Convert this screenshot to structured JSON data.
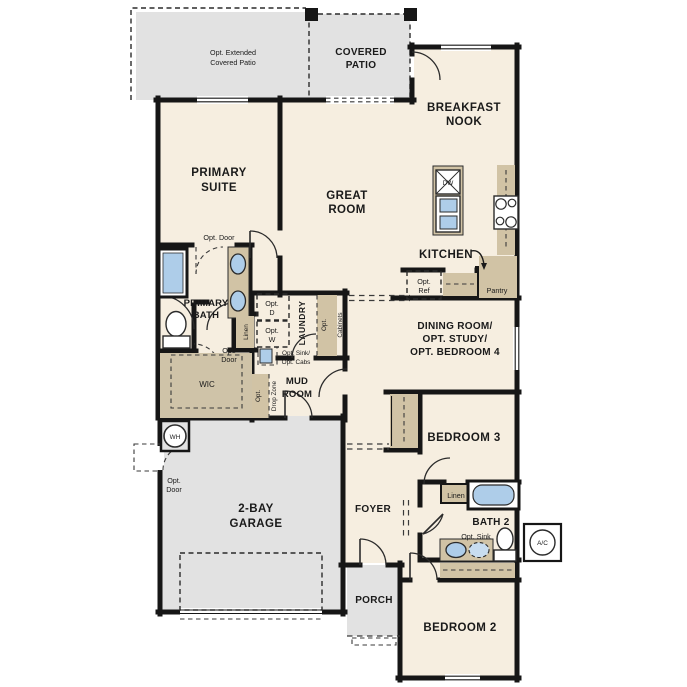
{
  "plan": {
    "title": "Single-story floor plan",
    "colors": {
      "floor": "#f6eee0",
      "outdoor_concrete": "#e2e2e2",
      "cabinet_tan": "#d1c3a5",
      "fixture_blue": "#aecde9",
      "wall": "#161616",
      "opt_box_gray": "#e8e8e4"
    },
    "outdoor": {
      "opt_extended_patio": {
        "lines": [
          "Opt. Extended",
          "Covered Patio"
        ]
      },
      "covered_patio": {
        "lines": [
          "COVERED",
          "PATIO"
        ]
      },
      "porch": {
        "label": "PORCH"
      },
      "garage": {
        "lines": [
          "2-BAY",
          "GARAGE"
        ]
      }
    },
    "rooms": {
      "breakfast_nook": {
        "lines": [
          "BREAKFAST",
          "NOOK"
        ]
      },
      "great_room": {
        "lines": [
          "GREAT",
          "ROOM"
        ]
      },
      "primary_suite": {
        "lines": [
          "PRIMARY",
          "SUITE"
        ]
      },
      "kitchen": {
        "label": "KITCHEN"
      },
      "dining": {
        "lines": [
          "DINING ROOM/",
          "OPT. STUDY/",
          "OPT. BEDROOM 4"
        ]
      },
      "primary_bath": {
        "lines": [
          "PRIMARY",
          "BATH"
        ]
      },
      "wic": {
        "label": "WIC"
      },
      "laundry": {
        "label": "LAUNDRY"
      },
      "mud_room": {
        "lines": [
          "MUD",
          "ROOM"
        ]
      },
      "foyer": {
        "label": "FOYER"
      },
      "bedroom3": {
        "label": "BEDROOM 3"
      },
      "bath2": {
        "label": "BATH 2"
      },
      "bedroom2": {
        "label": "BEDROOM 2"
      }
    },
    "annotations": {
      "opt_door_suite": {
        "label": "Opt. Door"
      },
      "opt_door_wic": {
        "lines": [
          "Opt.",
          "Door"
        ]
      },
      "opt_door_garage": {
        "lines": [
          "Opt.",
          "Door"
        ]
      },
      "linen_primary": {
        "label": "Linen"
      },
      "linen_bath2": {
        "label": "Linen"
      },
      "pantry": {
        "label": "Pantry"
      },
      "opt_ref": {
        "lines": [
          "Opt.",
          "Ref"
        ]
      },
      "opt_dryer": {
        "lines": [
          "Opt.",
          "D"
        ]
      },
      "opt_washer": {
        "lines": [
          "Opt.",
          "W"
        ]
      },
      "opt_cabinets": {
        "lines": [
          "Opt.",
          "Cabinets"
        ]
      },
      "opt_sink_cabs": {
        "lines": [
          "Opt. Sink/",
          "Opt. Cabs"
        ]
      },
      "opt_drop_zone": {
        "lines": [
          "Opt.",
          "Drop Zone"
        ]
      },
      "opt_sink_bath2": {
        "label": "Opt. Sink"
      },
      "dishwasher": {
        "label": "DW"
      },
      "water_heater": {
        "label": "WH"
      },
      "ac_unit": {
        "label": "A/C"
      }
    }
  }
}
